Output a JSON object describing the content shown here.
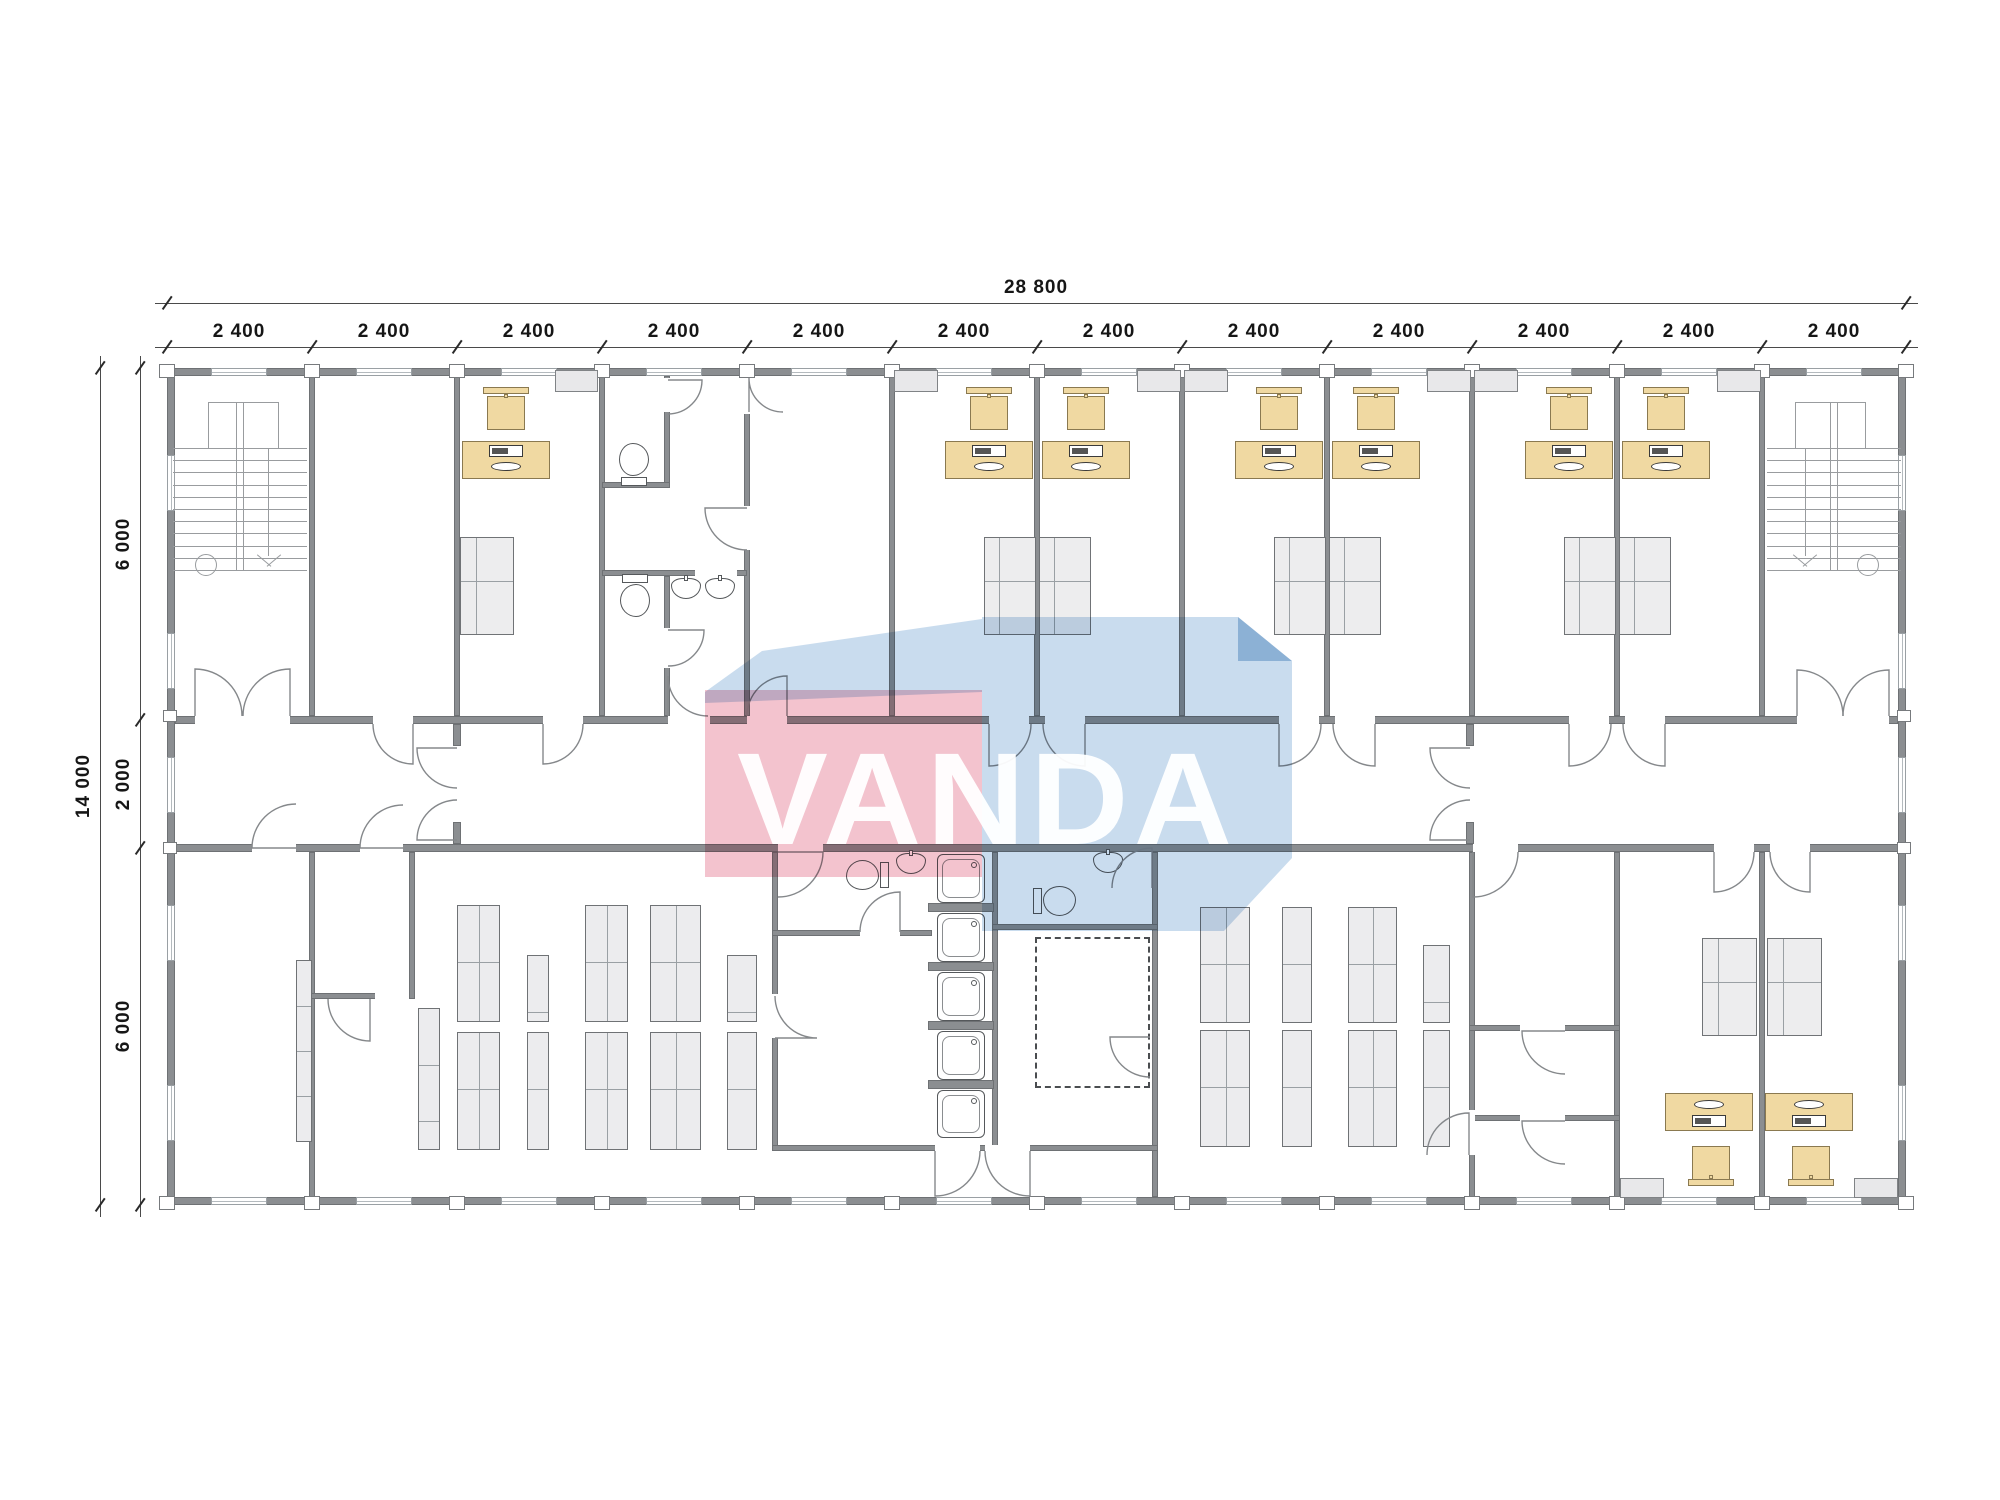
{
  "watermark": {
    "text": "VANDA",
    "pink_color": "#f3c3ce",
    "blue_color": "#c9dcee",
    "blue_dark_color": "#b2cde5",
    "pink_rect": [
      705,
      690,
      277,
      187
    ],
    "blue_top_poly": [
      [
        762,
        651
      ],
      [
        982,
        619
      ],
      [
        982,
        692
      ],
      [
        705,
        703
      ],
      [
        705,
        692
      ]
    ],
    "blue_main_poly": [
      [
        982,
        617
      ],
      [
        1238,
        617
      ],
      [
        1292,
        661
      ],
      [
        1292,
        858
      ],
      [
        1224,
        931
      ],
      [
        982,
        931
      ]
    ],
    "blue_bevel_poly": [
      [
        1238,
        617
      ],
      [
        1292,
        661
      ],
      [
        1238,
        661
      ]
    ],
    "text_pos": [
      737,
      723
    ]
  },
  "dimensions": {
    "top_total_label": "28 800",
    "top_total_line": {
      "y": 303,
      "x1": 155,
      "x2": 1918,
      "ticks": [
        167,
        1906
      ],
      "label_pos": [
        1036,
        278
      ]
    },
    "top_segment_labels": [
      "2 400",
      "2 400",
      "2 400",
      "2 400",
      "2 400",
      "2 400",
      "2 400",
      "2 400",
      "2 400",
      "2 400",
      "2 400",
      "2 400"
    ],
    "top_segment_line": {
      "y": 347,
      "x1": 155,
      "x2": 1918,
      "ticks": [
        167,
        312,
        457,
        602,
        747,
        892,
        1037,
        1182,
        1327,
        1472,
        1617,
        1762,
        1906
      ],
      "label_y": 322,
      "label_xs": [
        239,
        384,
        529,
        674,
        819,
        964,
        1109,
        1254,
        1399,
        1544,
        1689,
        1834
      ]
    },
    "left_total_label": "14 000",
    "left_total_line": {
      "x": 100,
      "y1": 356,
      "y2": 1217,
      "ticks": [
        368,
        1205
      ],
      "label_pos": [
        92,
        786
      ]
    },
    "left_segment_labels": [
      "6 000",
      "2 000",
      "6 000"
    ],
    "left_segment_line": {
      "x": 140,
      "y1": 356,
      "y2": 1217,
      "ticks": [
        368,
        720,
        848,
        1205
      ],
      "label_ys": [
        544,
        784,
        1026
      ],
      "label_x": 132
    }
  },
  "plan": {
    "wall_color": "#8b8e91",
    "walls": [
      [
        167,
        368,
        1739,
        8
      ],
      [
        167,
        1197,
        1739,
        8
      ],
      [
        167,
        376,
        8,
        821
      ],
      [
        1898,
        376,
        8,
        821
      ],
      [
        175,
        716,
        1723,
        8
      ],
      [
        175,
        844,
        1723,
        8
      ],
      [
        309,
        376,
        6,
        340
      ],
      [
        454,
        376,
        6,
        340
      ],
      [
        599,
        376,
        6,
        340
      ],
      [
        744,
        376,
        6,
        340
      ],
      [
        889,
        376,
        6,
        340
      ],
      [
        1034,
        376,
        6,
        340
      ],
      [
        1179,
        376,
        6,
        340
      ],
      [
        1324,
        376,
        6,
        340
      ],
      [
        1469,
        376,
        6,
        340
      ],
      [
        1614,
        376,
        6,
        340
      ],
      [
        1759,
        376,
        6,
        340
      ],
      [
        664,
        376,
        6,
        112
      ],
      [
        602,
        482,
        68,
        6
      ],
      [
        602,
        570,
        145,
        6
      ],
      [
        664,
        576,
        6,
        140
      ],
      [
        309,
        852,
        6,
        345
      ],
      [
        409,
        852,
        6,
        147
      ],
      [
        772,
        852,
        6,
        299
      ],
      [
        992,
        852,
        6,
        299
      ],
      [
        1152,
        852,
        6,
        345
      ],
      [
        1469,
        852,
        6,
        345
      ],
      [
        1614,
        852,
        6,
        345
      ],
      [
        1759,
        852,
        6,
        345
      ],
      [
        309,
        993,
        70,
        6
      ],
      [
        772,
        930,
        160,
        6
      ],
      [
        992,
        924,
        166,
        6
      ],
      [
        772,
        1145,
        386,
        6
      ],
      [
        1469,
        1025,
        151,
        6
      ],
      [
        1469,
        1115,
        151,
        6
      ],
      [
        453,
        724,
        8,
        22
      ],
      [
        453,
        822,
        8,
        22
      ],
      [
        1466,
        724,
        8,
        22
      ],
      [
        1466,
        822,
        8,
        22
      ]
    ],
    "gaps": [
      [
        195,
        716,
        95,
        8
      ],
      [
        373,
        716,
        40,
        8
      ],
      [
        543,
        716,
        40,
        8
      ],
      [
        668,
        716,
        42,
        8
      ],
      [
        747,
        716,
        40,
        8
      ],
      [
        989,
        716,
        40,
        8
      ],
      [
        1045,
        716,
        40,
        8
      ],
      [
        1279,
        716,
        40,
        8
      ],
      [
        1335,
        716,
        40,
        8
      ],
      [
        1569,
        716,
        40,
        8
      ],
      [
        1625,
        716,
        40,
        8
      ],
      [
        1797,
        716,
        92,
        8
      ],
      [
        252,
        844,
        44,
        8
      ],
      [
        360,
        844,
        43,
        8
      ],
      [
        778,
        844,
        45,
        8
      ],
      [
        1473,
        844,
        45,
        8
      ],
      [
        1714,
        844,
        40,
        8
      ],
      [
        1770,
        844,
        40,
        8
      ],
      [
        664,
        378,
        6,
        34
      ],
      [
        744,
        378,
        6,
        36
      ],
      [
        744,
        506,
        6,
        44
      ],
      [
        695,
        570,
        42,
        6
      ],
      [
        664,
        628,
        6,
        40
      ],
      [
        375,
        993,
        34,
        6
      ],
      [
        935,
        1145,
        45,
        6
      ],
      [
        985,
        1145,
        45,
        6
      ],
      [
        1520,
        1025,
        45,
        6
      ],
      [
        1520,
        1115,
        45,
        6
      ],
      [
        1469,
        1110,
        6,
        45
      ],
      [
        772,
        994,
        6,
        44
      ],
      [
        860,
        930,
        40,
        6
      ]
    ],
    "markers_x": [
      167,
      312,
      457,
      602,
      747,
      892,
      1037,
      1182,
      1327,
      1472,
      1617,
      1762,
      1906
    ],
    "marker_rows_y": [
      364,
      1196
    ],
    "side_markers": [
      [
        163,
        710,
        14,
        12
      ],
      [
        163,
        842,
        14,
        12
      ],
      [
        1897,
        710,
        14,
        12
      ],
      [
        1897,
        842,
        14,
        12
      ]
    ],
    "windows_h_modules_x": [
      167,
      312,
      457,
      602,
      747,
      892,
      1037,
      1182,
      1327,
      1472,
      1617,
      1762
    ],
    "windows_h_rows_y": [
      368,
      1197
    ],
    "windows_v_ys": [
      455,
      633,
      757,
      905,
      1085
    ],
    "windows_v_cols_x": [
      167,
      1898
    ],
    "doors": [
      [
        195,
        716,
        47,
        270,
        360
      ],
      [
        290,
        716,
        47,
        270,
        180
      ],
      [
        1797,
        716,
        46,
        270,
        360
      ],
      [
        1889,
        716,
        46,
        270,
        180
      ],
      [
        413,
        724,
        40,
        90,
        180
      ],
      [
        543,
        724,
        40,
        90,
        0
      ],
      [
        668,
        716,
        40,
        270,
        0
      ],
      [
        787,
        716,
        40,
        270,
        180
      ],
      [
        989,
        724,
        42,
        90,
        0
      ],
      [
        1085,
        724,
        42,
        90,
        180
      ],
      [
        1279,
        724,
        42,
        90,
        0
      ],
      [
        1375,
        724,
        42,
        90,
        180
      ],
      [
        1569,
        724,
        42,
        90,
        0
      ],
      [
        1665,
        724,
        42,
        90,
        180
      ],
      [
        457,
        748,
        40,
        180,
        90
      ],
      [
        457,
        840,
        40,
        180,
        270
      ],
      [
        1470,
        748,
        40,
        180,
        90
      ],
      [
        1470,
        840,
        40,
        180,
        270
      ],
      [
        296,
        848,
        44,
        180,
        270
      ],
      [
        403,
        848,
        43,
        180,
        270
      ],
      [
        370,
        999,
        42,
        90,
        180
      ],
      [
        778,
        852,
        45,
        0,
        90
      ],
      [
        900,
        932,
        40,
        270,
        180
      ],
      [
        775,
        1038,
        42,
        0,
        270
      ],
      [
        1152,
        888,
        40,
        270,
        180
      ],
      [
        1150,
        1037,
        40,
        180,
        90
      ],
      [
        935,
        1151,
        45,
        90,
        0
      ],
      [
        1030,
        1151,
        45,
        90,
        180
      ],
      [
        1473,
        852,
        45,
        90,
        0
      ],
      [
        1565,
        1031,
        43,
        180,
        90
      ],
      [
        1565,
        1121,
        43,
        180,
        90
      ],
      [
        1469,
        1155,
        42,
        270,
        180
      ],
      [
        1714,
        852,
        40,
        90,
        0
      ],
      [
        1810,
        852,
        40,
        90,
        180
      ],
      [
        668,
        380,
        34,
        0,
        90
      ],
      [
        749,
        412,
        34,
        270,
        0
      ],
      [
        747,
        508,
        42,
        180,
        90
      ],
      [
        668,
        630,
        36,
        0,
        90
      ]
    ],
    "desks": [
      [
        462,
        441,
        88,
        38,
        1
      ],
      [
        945,
        441,
        88,
        38,
        1
      ],
      [
        1042,
        441,
        88,
        38,
        1
      ],
      [
        1235,
        441,
        88,
        38,
        1
      ],
      [
        1332,
        441,
        88,
        38,
        1
      ],
      [
        1525,
        441,
        88,
        38,
        1
      ],
      [
        1622,
        441,
        88,
        38,
        1
      ],
      [
        1665,
        1093,
        88,
        38,
        -1
      ],
      [
        1765,
        1093,
        88,
        38,
        -1
      ]
    ],
    "chairs": [
      [
        506,
        411,
        1
      ],
      [
        989,
        411,
        1
      ],
      [
        1086,
        411,
        1
      ],
      [
        1279,
        411,
        1
      ],
      [
        1376,
        411,
        1
      ],
      [
        1569,
        411,
        1
      ],
      [
        1666,
        411,
        1
      ],
      [
        1711,
        1161,
        -1
      ],
      [
        1811,
        1161,
        -1
      ]
    ],
    "wards": [
      [
        460,
        537,
        54,
        98
      ],
      [
        984,
        537,
        52,
        98
      ],
      [
        1039,
        537,
        52,
        98
      ],
      [
        1274,
        537,
        52,
        98
      ],
      [
        1329,
        537,
        52,
        98
      ],
      [
        1564,
        537,
        52,
        98
      ],
      [
        1619,
        537,
        52,
        98
      ],
      [
        1702,
        938,
        55,
        98
      ],
      [
        1767,
        938,
        55,
        98
      ]
    ],
    "cabs": [
      [
        555,
        370,
        43,
        22
      ],
      [
        894,
        370,
        44,
        22
      ],
      [
        1137,
        370,
        44,
        22
      ],
      [
        1184,
        370,
        44,
        22
      ],
      [
        1427,
        370,
        44,
        22
      ],
      [
        1474,
        370,
        44,
        22
      ],
      [
        1717,
        370,
        44,
        22
      ],
      [
        1620,
        1178,
        44,
        20
      ],
      [
        1854,
        1178,
        44,
        20
      ]
    ],
    "strips": [
      [
        296,
        960,
        16,
        182
      ]
    ],
    "racks": [
      [
        418,
        1008,
        22,
        142,
        1
      ],
      [
        457,
        905,
        43,
        117,
        2
      ],
      [
        457,
        1032,
        43,
        118,
        2
      ],
      [
        527,
        955,
        22,
        67,
        1
      ],
      [
        527,
        1032,
        22,
        118,
        1
      ],
      [
        585,
        905,
        43,
        117,
        2
      ],
      [
        585,
        1032,
        43,
        118,
        2
      ],
      [
        650,
        905,
        51,
        117,
        2
      ],
      [
        650,
        1032,
        51,
        118,
        2
      ],
      [
        727,
        955,
        30,
        67,
        1
      ],
      [
        727,
        1032,
        30,
        118,
        1
      ],
      [
        1200,
        907,
        50,
        116,
        2
      ],
      [
        1200,
        1030,
        50,
        117,
        2
      ],
      [
        1282,
        907,
        30,
        116,
        1
      ],
      [
        1282,
        1030,
        30,
        117,
        1
      ],
      [
        1348,
        907,
        49,
        116,
        2
      ],
      [
        1348,
        1030,
        49,
        117,
        2
      ],
      [
        1423,
        945,
        27,
        78,
        1
      ],
      [
        1423,
        1030,
        27,
        117,
        1
      ]
    ],
    "toilets": [
      [
        634,
        463,
        -90
      ],
      [
        635,
        597,
        90
      ],
      [
        866,
        875,
        180
      ],
      [
        1056,
        901,
        0
      ]
    ],
    "sinks": [
      [
        687,
        588,
        0
      ],
      [
        721,
        588,
        0
      ],
      [
        912,
        863,
        0
      ],
      [
        1109,
        862,
        0
      ]
    ],
    "shower_trays": [
      [
        937,
        854,
        48,
        49
      ],
      [
        937,
        913,
        48,
        49
      ],
      [
        937,
        972,
        48,
        49
      ],
      [
        937,
        1031,
        48,
        49
      ],
      [
        937,
        1090,
        48,
        48
      ]
    ],
    "shower_divs": [
      [
        928,
        903,
        66,
        9
      ],
      [
        928,
        962,
        66,
        9
      ],
      [
        928,
        1021,
        66,
        9
      ],
      [
        928,
        1080,
        66,
        9
      ]
    ],
    "dashed_rooms": [
      [
        1035,
        937,
        115,
        151
      ]
    ],
    "stairs": [
      {
        "x": 173,
        "y": 402,
        "w": 134,
        "h": 168,
        "flip": false
      },
      {
        "x": 1767,
        "y": 402,
        "w": 134,
        "h": 168,
        "flip": true
      }
    ]
  }
}
